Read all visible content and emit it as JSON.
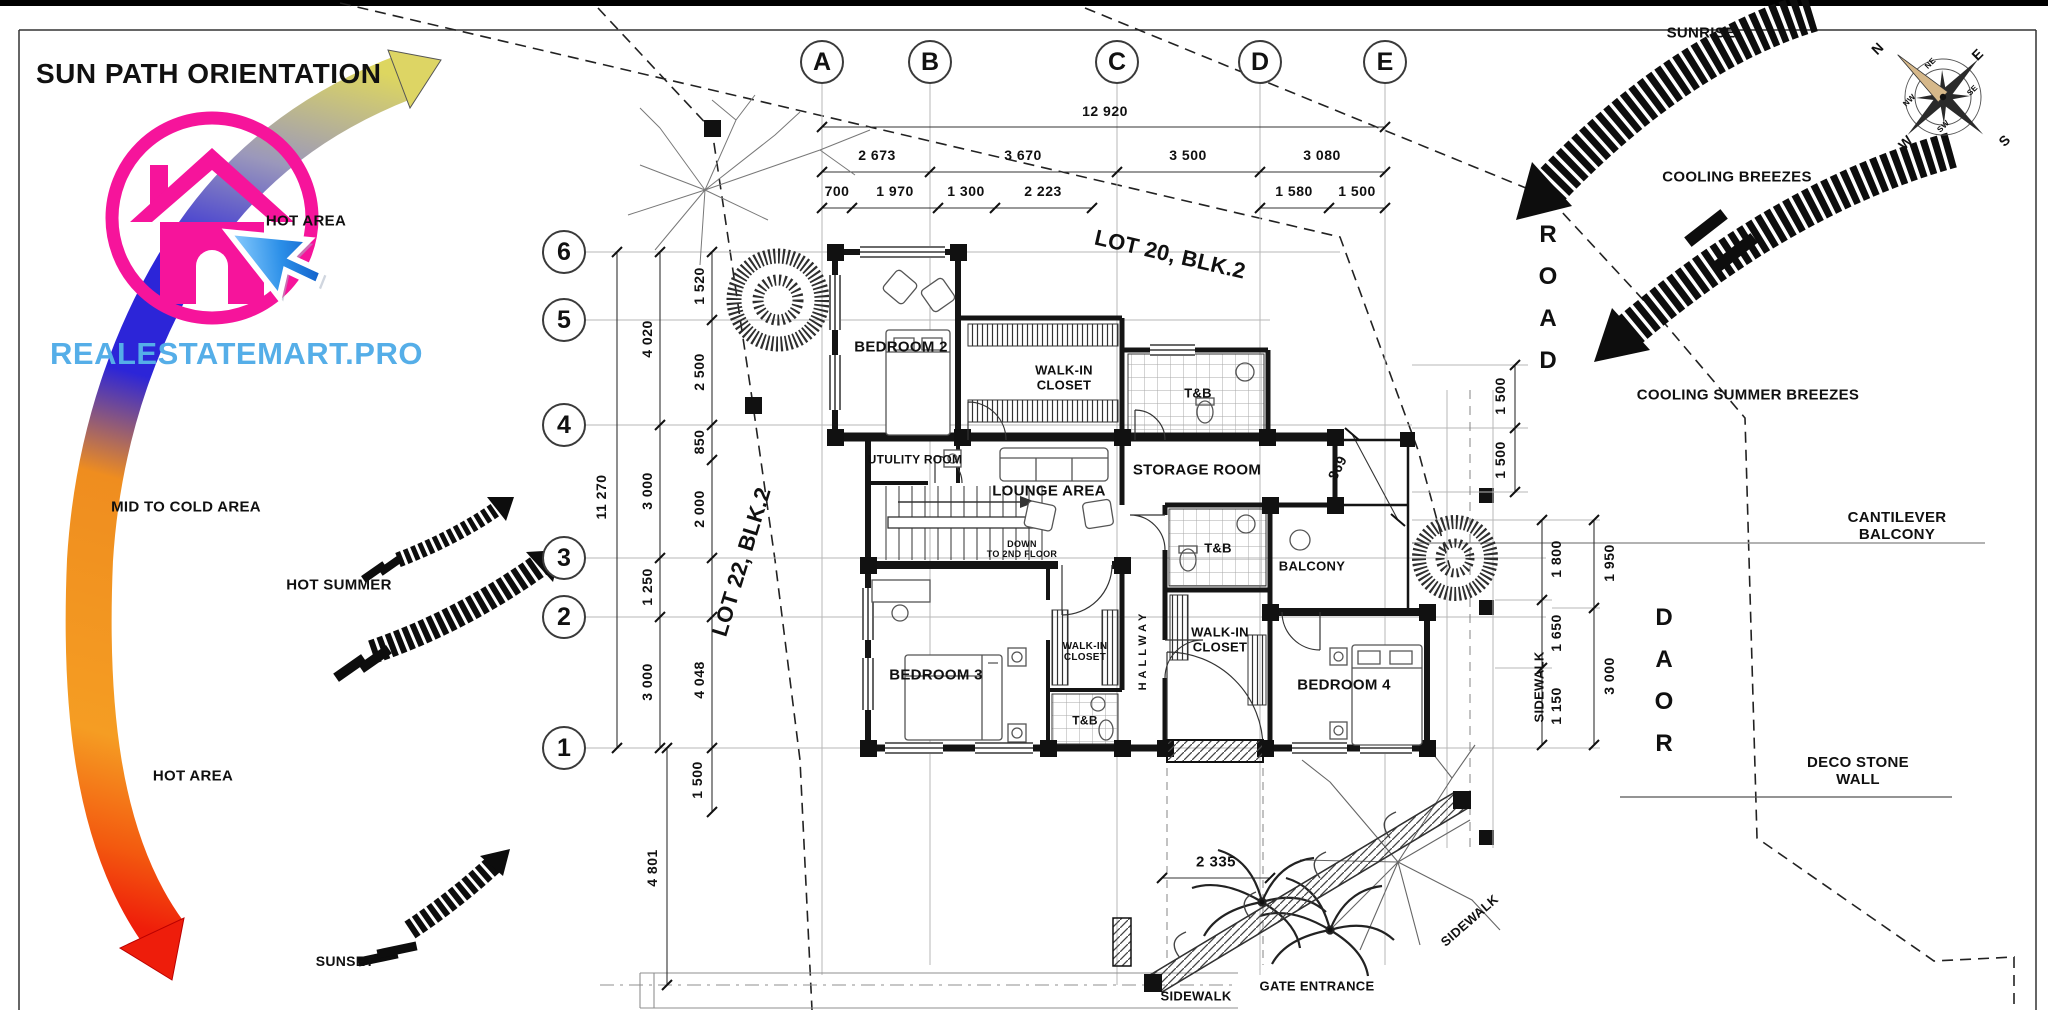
{
  "branding": {
    "title": "SUN PATH ORIENTATION",
    "watermark": "REALESTATEMART.PRO",
    "logo_ring_color": "#f6149b",
    "logo_house_color": "#f6149b",
    "cursor_color": "#2b8fe8",
    "watermark_color": "#55aee8"
  },
  "grid": {
    "columns": [
      {
        "label": "A",
        "x": 822,
        "y": 62
      },
      {
        "label": "B",
        "x": 930,
        "y": 62
      },
      {
        "label": "C",
        "x": 1117,
        "y": 62
      },
      {
        "label": "D",
        "x": 1260,
        "y": 62
      },
      {
        "label": "E",
        "x": 1385,
        "y": 62
      }
    ],
    "rows": [
      {
        "label": "6",
        "x": 564,
        "y": 252
      },
      {
        "label": "5",
        "x": 564,
        "y": 320
      },
      {
        "label": "4",
        "x": 564,
        "y": 425
      },
      {
        "label": "3",
        "x": 564,
        "y": 558
      },
      {
        "label": "2",
        "x": 564,
        "y": 617
      },
      {
        "label": "1",
        "x": 564,
        "y": 748
      }
    ]
  },
  "label_groups": {
    "sun": [
      {
        "n": "hot-area-upper-label",
        "t": "HOT AREA",
        "x": 306,
        "y": 222,
        "s": 15
      },
      {
        "n": "mid-to-cold-area-label",
        "t": "MID TO COLD AREA",
        "x": 186,
        "y": 508,
        "s": 15
      },
      {
        "n": "hot-summer-label",
        "t": "HOT SUMMER",
        "x": 339,
        "y": 586,
        "s": 15
      },
      {
        "n": "hot-area-lower-label",
        "t": "HOT AREA",
        "x": 193,
        "y": 777,
        "s": 15
      },
      {
        "n": "sunset-label",
        "t": "SUNSET",
        "x": 345,
        "y": 962,
        "s": 14
      },
      {
        "n": "sunrise-label",
        "t": "SUNRISE",
        "x": 1701,
        "y": 34,
        "s": 15
      },
      {
        "n": "cooling-breezes-label",
        "t": "COOLING BREEZES",
        "x": 1737,
        "y": 178,
        "s": 15
      },
      {
        "n": "cooling-summer-breezes-label",
        "t": "COOLING SUMMER BREEZES",
        "x": 1748,
        "y": 396,
        "s": 15
      }
    ],
    "site": [
      {
        "n": "lot-20-label",
        "t": "LOT 20, BLK.2",
        "x": 1170,
        "y": 255,
        "s": 22,
        "r": 13
      },
      {
        "n": "lot-22-label",
        "t": "LOT 22, BLK.2",
        "x": 742,
        "y": 562,
        "s": 22,
        "r": -73
      },
      {
        "n": "road-top-label",
        "t": "ROAD",
        "x": 1548,
        "y": 298,
        "s": 24,
        "c": "roadv vstack"
      },
      {
        "n": "road-right-label",
        "t": "ROAD",
        "x": 1664,
        "y": 681,
        "s": 24,
        "c": "roadv vstack rev"
      },
      {
        "n": "cantilever-balcony-label",
        "t": "CANTILEVER BALCONY",
        "x": 1897,
        "y": 527,
        "s": 15
      },
      {
        "n": "deco-stone-wall-label",
        "t": "DECO STONE\nWALL",
        "x": 1858,
        "y": 772,
        "s": 15
      },
      {
        "n": "sidewalk-right-label",
        "t": "SIDEWALK",
        "x": 1540,
        "y": 687,
        "s": 13,
        "r": -90
      },
      {
        "n": "sidewalk-diagonal-label",
        "t": "SIDEWALK",
        "x": 1470,
        "y": 921,
        "s": 13,
        "r": -41
      },
      {
        "n": "sidewalk-bottom-label",
        "t": "SIDEWALK",
        "x": 1196,
        "y": 997,
        "s": 13
      },
      {
        "n": "gate-entrance-label",
        "t": "GATE ENTRANCE",
        "x": 1317,
        "y": 987,
        "s": 13
      }
    ],
    "rooms": [
      {
        "n": "bedroom-2-label",
        "t": "BEDROOM 2",
        "x": 901,
        "y": 348,
        "s": 15
      },
      {
        "n": "walk-in-closet-1-label",
        "t": "WALK-IN\nCLOSET",
        "x": 1064,
        "y": 378,
        "s": 13
      },
      {
        "n": "tb-1-label",
        "t": "T&B",
        "x": 1198,
        "y": 394,
        "s": 13
      },
      {
        "n": "utility-room-label",
        "t": "UTULITY ROOM",
        "x": 915,
        "y": 460,
        "s": 12
      },
      {
        "n": "lounge-area-label",
        "t": "LOUNGE AREA",
        "x": 1049,
        "y": 492,
        "s": 15
      },
      {
        "n": "storage-room-label",
        "t": "STORAGE ROOM",
        "x": 1197,
        "y": 471,
        "s": 15
      },
      {
        "n": "stairs-down-label",
        "t": "DOWN\nTO 2ND FLOOR",
        "x": 1022,
        "y": 549,
        "s": 9
      },
      {
        "n": "tb-2-label",
        "t": "T&B",
        "x": 1218,
        "y": 549,
        "s": 13
      },
      {
        "n": "balcony-label",
        "t": "BALCONY",
        "x": 1312,
        "y": 567,
        "s": 13
      },
      {
        "n": "hallway-label",
        "t": "HALLWAY",
        "x": 1143,
        "y": 650,
        "s": 11,
        "r": -90,
        "c": "sp"
      },
      {
        "n": "bedroom-3-label",
        "t": "BEDROOM 3",
        "x": 936,
        "y": 676,
        "s": 15
      },
      {
        "n": "walk-in-closet-3-label",
        "t": "WALK-IN\nCLOSET",
        "x": 1085,
        "y": 652,
        "s": 10
      },
      {
        "n": "walk-in-closet-2-label",
        "t": "WALK-IN\nCLOSET",
        "x": 1220,
        "y": 640,
        "s": 13
      },
      {
        "n": "tb-3-label",
        "t": "T&B",
        "x": 1085,
        "y": 721,
        "s": 12
      },
      {
        "n": "bedroom-4-label",
        "t": "BEDROOM 4",
        "x": 1344,
        "y": 686,
        "s": 15
      }
    ],
    "dims_top": [
      {
        "n": "dim-overall-width",
        "t": "12 920",
        "x": 1105,
        "y": 112,
        "s": 14,
        "c": "dim"
      },
      {
        "t": "2 673",
        "x": 877,
        "y": 156,
        "s": 14,
        "c": "dim"
      },
      {
        "t": "3 670",
        "x": 1023,
        "y": 156,
        "s": 14,
        "c": "dim"
      },
      {
        "t": "3 500",
        "x": 1188,
        "y": 156,
        "s": 14,
        "c": "dim"
      },
      {
        "t": "3 080",
        "x": 1322,
        "y": 156,
        "s": 14,
        "c": "dim"
      },
      {
        "t": "700",
        "x": 837,
        "y": 192,
        "s": 14,
        "c": "dim"
      },
      {
        "t": "1 970",
        "x": 895,
        "y": 192,
        "s": 14,
        "c": "dim"
      },
      {
        "t": "1 300",
        "x": 966,
        "y": 192,
        "s": 14,
        "c": "dim"
      },
      {
        "t": "2 223",
        "x": 1043,
        "y": 192,
        "s": 14,
        "c": "dim"
      },
      {
        "t": "1 580",
        "x": 1294,
        "y": 192,
        "s": 14,
        "c": "dim"
      },
      {
        "t": "1 500",
        "x": 1357,
        "y": 192,
        "s": 14,
        "c": "dim"
      }
    ],
    "dims_left": [
      {
        "n": "dim-overall-height",
        "t": "11 270",
        "x": 602,
        "y": 497,
        "s": 14,
        "r": -90,
        "c": "dim"
      },
      {
        "t": "4 020",
        "x": 648,
        "y": 339,
        "s": 14,
        "r": -90,
        "c": "dim"
      },
      {
        "t": "3 000",
        "x": 648,
        "y": 491,
        "s": 14,
        "r": -90,
        "c": "dim"
      },
      {
        "t": "1 250",
        "x": 648,
        "y": 587,
        "s": 14,
        "r": -90,
        "c": "dim"
      },
      {
        "t": "3 000",
        "x": 648,
        "y": 682,
        "s": 14,
        "r": -90,
        "c": "dim"
      },
      {
        "t": "1 520",
        "x": 700,
        "y": 286,
        "s": 14,
        "r": -90,
        "c": "dim"
      },
      {
        "t": "2 500",
        "x": 700,
        "y": 372,
        "s": 14,
        "r": -90,
        "c": "dim"
      },
      {
        "t": "850",
        "x": 700,
        "y": 442,
        "s": 14,
        "r": -90,
        "c": "dim"
      },
      {
        "t": "2 000",
        "x": 700,
        "y": 509,
        "s": 14,
        "r": -90,
        "c": "dim"
      },
      {
        "t": "4 048",
        "x": 700,
        "y": 680,
        "s": 14,
        "r": -90,
        "c": "dim"
      },
      {
        "t": "1 500",
        "x": 698,
        "y": 780,
        "s": 14,
        "r": -90,
        "c": "dim"
      },
      {
        "t": "4 801",
        "x": 653,
        "y": 868,
        "s": 14,
        "r": -90,
        "c": "dim"
      }
    ],
    "dims_right": [
      {
        "t": "1 500",
        "x": 1501,
        "y": 396,
        "s": 14,
        "r": -90,
        "c": "dim"
      },
      {
        "t": "1 500",
        "x": 1501,
        "y": 460,
        "s": 14,
        "r": -90,
        "c": "dim"
      },
      {
        "t": "1 800",
        "x": 1557,
        "y": 559,
        "s": 14,
        "r": -90,
        "c": "dim"
      },
      {
        "t": "1 950",
        "x": 1610,
        "y": 563,
        "s": 14,
        "r": -90,
        "c": "dim"
      },
      {
        "t": "1 650",
        "x": 1557,
        "y": 633,
        "s": 14,
        "r": -90,
        "c": "dim"
      },
      {
        "t": "3 000",
        "x": 1610,
        "y": 676,
        "s": 14,
        "r": -90,
        "c": "dim"
      },
      {
        "t": "1 150",
        "x": 1557,
        "y": 706,
        "s": 14,
        "r": -90,
        "c": "dim"
      },
      {
        "t": "869",
        "x": 1338,
        "y": 468,
        "s": 14,
        "r": -63,
        "c": "dim"
      },
      {
        "t": "2 335",
        "x": 1216,
        "y": 863,
        "s": 15,
        "c": "dim"
      }
    ],
    "compass": [
      {
        "n": "compass-n",
        "t": "N",
        "x": 1878,
        "y": 49,
        "s": 14,
        "r": -45
      },
      {
        "n": "compass-ne",
        "t": "NE",
        "x": 1931,
        "y": 64,
        "s": 8,
        "r": -45
      },
      {
        "n": "compass-e",
        "t": "E",
        "x": 1978,
        "y": 55,
        "s": 14,
        "r": -45
      },
      {
        "n": "compass-se",
        "t": "SE",
        "x": 1973,
        "y": 91,
        "s": 8,
        "r": -45
      },
      {
        "n": "compass-s",
        "t": "S",
        "x": 2005,
        "y": 141,
        "s": 14,
        "r": -45
      },
      {
        "n": "compass-sw",
        "t": "SW",
        "x": 1944,
        "y": 127,
        "s": 8,
        "r": -45
      },
      {
        "n": "compass-w",
        "t": "W",
        "x": 1906,
        "y": 143,
        "s": 14,
        "r": -45
      },
      {
        "n": "compass-nw",
        "t": "NW",
        "x": 1910,
        "y": 101,
        "s": 8,
        "r": -45
      }
    ]
  }
}
